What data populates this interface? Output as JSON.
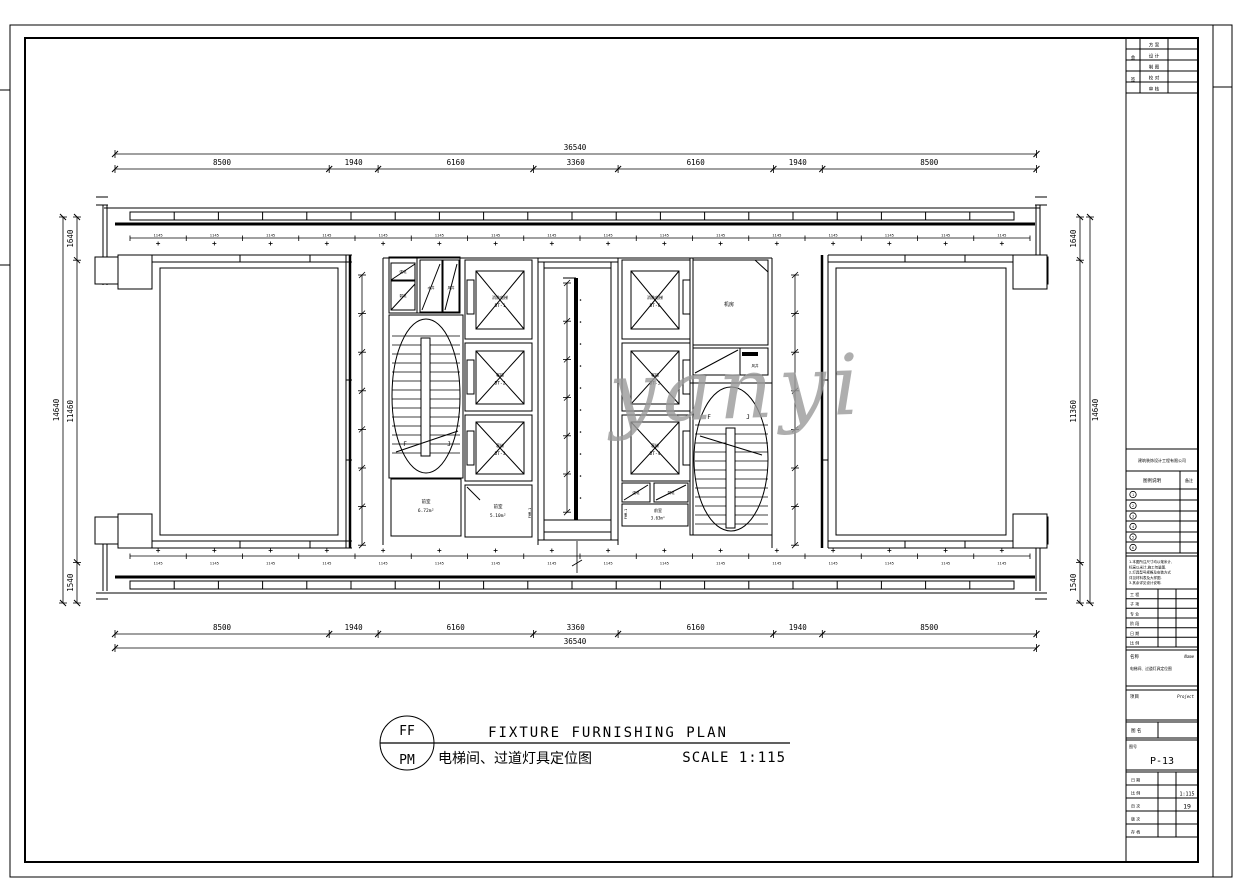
{
  "watermark": "yanyi",
  "drawing_title": {
    "stamp_top": "FF",
    "stamp_bottom": "PM",
    "title_en": "FIXTURE FURNISHING PLAN",
    "title_cn": "电梯间、过道灯具定位图",
    "scale_label": "SCALE 1:115"
  },
  "dimensions": {
    "top": {
      "total": "36540",
      "segments": [
        "8500",
        "1940",
        "6160",
        "3360",
        "6160",
        "1940",
        "8500"
      ]
    },
    "bottom": {
      "total": "36540",
      "segments": [
        "8500",
        "1940",
        "6160",
        "3360",
        "6160",
        "1940",
        "8500"
      ]
    },
    "left": {
      "total": "14640",
      "segments": [
        "1640",
        "11460",
        "1540"
      ]
    },
    "right": {
      "total": "14640",
      "segments": [
        "1640",
        "11360",
        "1540"
      ]
    },
    "fixture_spacing": "1145"
  },
  "plan": {
    "elevators_left": [
      [
        "消防电梯",
        "DT-1"
      ],
      [
        "客梯",
        "DT-2"
      ],
      [
        "客梯",
        "DT-3"
      ]
    ],
    "elevators_right": [
      [
        "消防电梯",
        "DT-6"
      ],
      [
        "客梯",
        "DT-5"
      ],
      [
        "客梯",
        "DT-4"
      ]
    ],
    "rooms": {
      "r1": [
        "前室",
        "6.72m²"
      ],
      "r2": [
        "前室",
        "5.10m²"
      ],
      "r3": [
        "前室",
        "3.63m²"
      ],
      "r4": "机房"
    },
    "shaft_labels": [
      "强电",
      "弱电",
      "水井",
      "风井",
      "风井"
    ],
    "stair_marks": [
      "F",
      "J"
    ],
    "door_tag": "FHM-1"
  },
  "titleblock": {
    "sign_col": [
      "会",
      "签"
    ],
    "sign_rows": [
      "方 案",
      "设 计",
      "制 图",
      "校 对",
      "审 核"
    ],
    "company": "建筑装饰设计工程有限公司",
    "legend": {
      "header_left": "图例说明",
      "header_right": "备注",
      "symbols": [
        "1",
        "2",
        "3",
        "4",
        "5",
        "6"
      ]
    },
    "notes": [
      "1.本图所注尺寸均以毫米计,",
      "  标高以米计,施工勿量图.",
      "2.灯具型号规格及安装方式",
      "  详见材料表及大样图.",
      "3.其余详见设计说明."
    ],
    "info_rows": [
      "工  程",
      "子  项",
      "专  业",
      "阶  段",
      "日  期",
      "比  例"
    ],
    "name_label": "名称",
    "name_en": "Name",
    "name_value": "电梯间、过道灯具定位图",
    "project_label": "项目",
    "project_en": "Project",
    "sheet_name_label": "图 名",
    "number_label": "图号",
    "number_value": "P-13",
    "bottom_rows": [
      [
        "日 期",
        ""
      ],
      [
        "比 例",
        "1:115"
      ],
      [
        "页 次",
        "19"
      ],
      [
        "版 次",
        ""
      ],
      [
        "存 档",
        ""
      ]
    ]
  }
}
